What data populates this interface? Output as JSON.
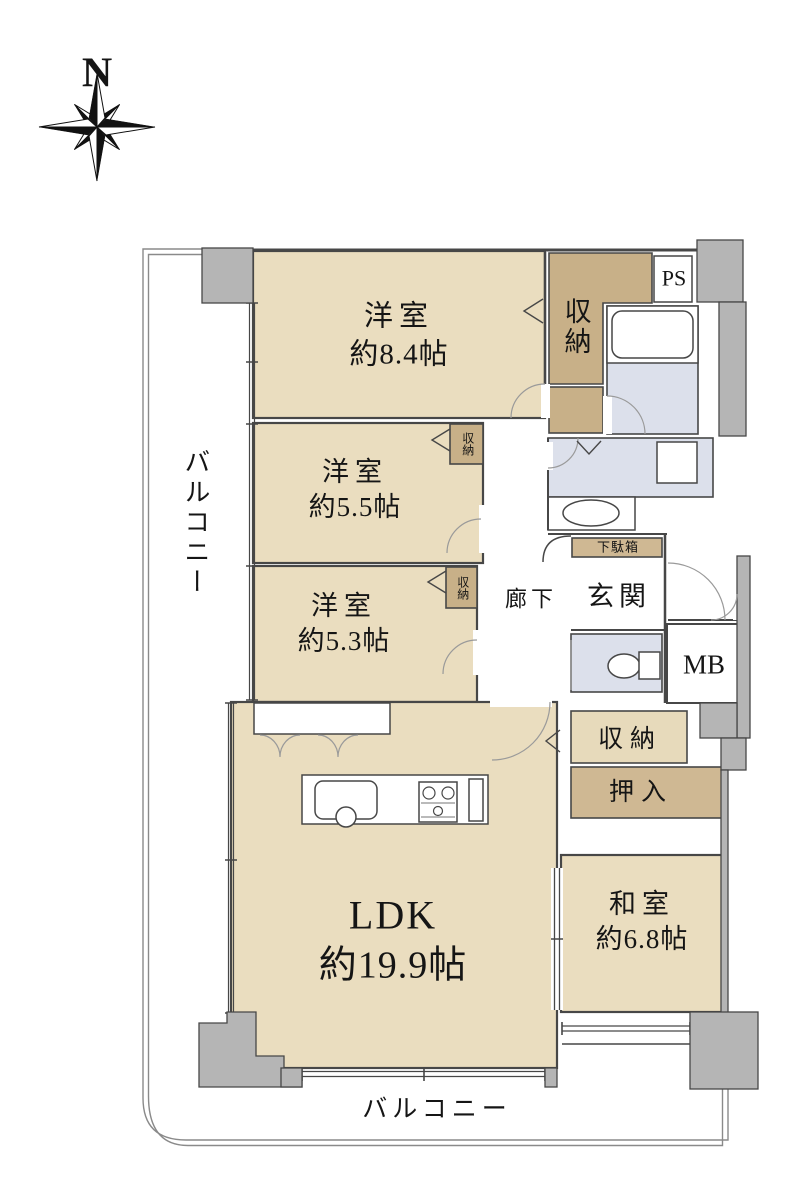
{
  "compass": {
    "north": "N"
  },
  "balconies": {
    "left": "バルコニー",
    "bottom": "バルコニー"
  },
  "rooms": {
    "western_84": {
      "name": "洋室",
      "size": "約8.4帖"
    },
    "western_55": {
      "name": "洋室",
      "size": "約5.5帖"
    },
    "western_53": {
      "name": "洋室",
      "size": "約5.3帖"
    },
    "ldk": {
      "name": "LDK",
      "size": "約19.9帖"
    },
    "japanese_68": {
      "name": "和室",
      "size": "約6.8帖"
    }
  },
  "storage": {
    "closet_main": "収納",
    "closet_55": "収納",
    "closet_53": "収納",
    "closet_hall": "収納",
    "oshiire": "押入",
    "shoe_cabinet": "下駄箱"
  },
  "areas": {
    "hallway": "廊下",
    "entrance": "玄関",
    "pipe_space": "PS",
    "meter_box": "MB"
  },
  "colors": {
    "room_fill": "#EADDBF",
    "closet_dark": "#C8B088",
    "closet_mid": "#CFB893",
    "closet_light": "#E7DABB",
    "wet_area": "#DCE0EB",
    "wall_gray": "#B5B5B5",
    "wall_line": "#474747"
  }
}
